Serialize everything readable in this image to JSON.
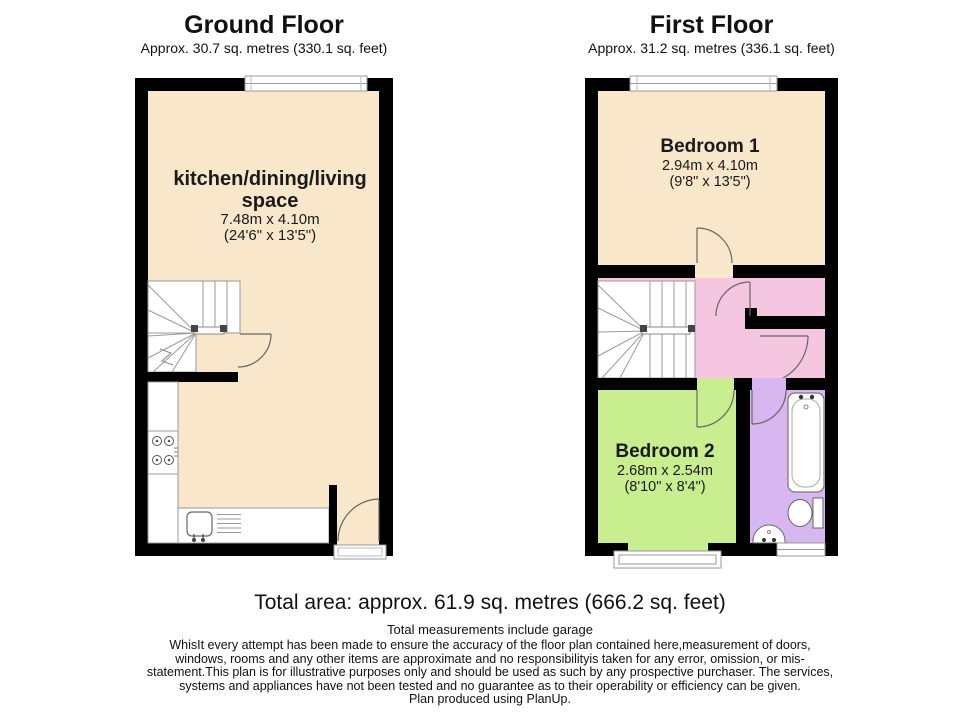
{
  "colors": {
    "wall": "#000000",
    "cream": "#F9E7CB",
    "pink": "#F5C6E0",
    "green": "#C9EE8F",
    "lavender": "#D8B6F0",
    "fixture": "#ffffff"
  },
  "ground_floor": {
    "title": "Ground Floor",
    "subtitle": "Approx. 30.7 sq. metres (330.1 sq. feet)",
    "room": {
      "name_line1": "kitchen/dining/living",
      "name_line2": "space",
      "dims_metric": "7.48m x 4.10m",
      "dims_imperial": "(24'6\" x 13'5\")"
    }
  },
  "first_floor": {
    "title": "First Floor",
    "subtitle": "Approx. 31.2 sq. metres (336.1 sq. feet)",
    "bedroom1": {
      "name": "Bedroom 1",
      "dims_metric": "2.94m x 4.10m",
      "dims_imperial": "(9'8\" x 13'5\")"
    },
    "bedroom2": {
      "name": "Bedroom 2",
      "dims_metric": "2.68m x 2.54m",
      "dims_imperial": "(8'10\" x 8'4\")"
    }
  },
  "footer": {
    "total_area": "Total area: approx. 61.9 sq. metres (666.2 sq. feet)",
    "note": "Total measurements include garage",
    "disclaimer_lines": [
      "WhisIt every attempt has been made to ensure the accuracy of the floor plan contained here,measurement of doors,",
      "windows, rooms and any other items are approximate and no responsibilityis taken for any error, omission, or mis-",
      "statement.This plan is for illustrative purposes only and should be used as such by any prospective purchaser. The services,",
      "systems and appliances have not been tested and no guarantee as to their operability or efficiency can be given.",
      "Plan produced using PlanUp."
    ]
  }
}
